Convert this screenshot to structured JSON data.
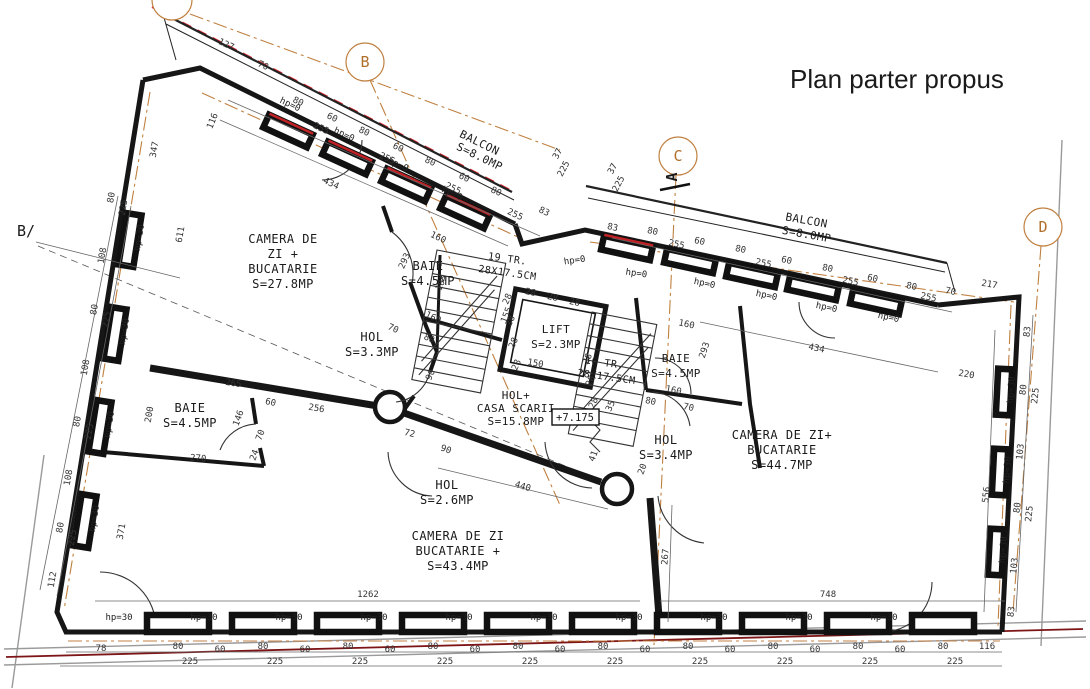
{
  "title": {
    "text": "Plan parter propus"
  },
  "colors": {
    "title": "#e0232a",
    "axis": "#c08040",
    "red_accent": "#d8232a"
  },
  "grid": {
    "b_left": "B/",
    "b": "B",
    "c": "C",
    "d": "D",
    "section_a": "A"
  },
  "labels": {
    "hp0": "hp=0",
    "hp30": "hp=30",
    "elevation": "+7.175",
    "tread": "28"
  },
  "rooms": {
    "camera1": {
      "line1": "CAMERA DE",
      "line2": "ZI +",
      "line3": "BUCATARIE",
      "area": "S=27.8MP"
    },
    "baie1": {
      "name": "BAIE",
      "area": "S=4.5MP"
    },
    "hol1": {
      "name": "HOL",
      "area": "S=3.3MP"
    },
    "lift": {
      "name": "LIFT",
      "area": "S=2.3MP"
    },
    "stairs_up": {
      "line1": "19 TR.",
      "line2": "28X17.5CM"
    },
    "stairs_down": {
      "line1": "16 TR.",
      "line2": "28X17.5CM"
    },
    "hol_scarii": {
      "line1": "HOL+",
      "line2": "CASA SCARII",
      "area": "S=15.8MP"
    },
    "baie2": {
      "name": "BAIE",
      "area": "S=4.5MP"
    },
    "hol2": {
      "name": "HOL",
      "area": "S=2.6MP"
    },
    "camera2": {
      "line1": "CAMERA DE ZI",
      "line2": "BUCATARIE +",
      "area": "S=43.4MP"
    },
    "hol3": {
      "name": "HOL",
      "area": "S=3.4MP"
    },
    "baie3": {
      "name": "BAIE",
      "area": "S=4.5MP"
    },
    "camera3": {
      "line1": "CAMERA DE ZI+",
      "line2": "BUCATARIE",
      "area": "S=44.7MP"
    },
    "balcon1": {
      "name": "BALCON",
      "area": "S=8.0MP"
    },
    "balcon2": {
      "name": "BALCON",
      "area": "S=8.0MP"
    }
  },
  "dims": {
    "bottom_chain": [
      "78",
      "80",
      "60",
      "80",
      "60",
      "80",
      "60",
      "80",
      "60",
      "80",
      "60",
      "80",
      "60",
      "80",
      "60",
      "80",
      "60",
      "80",
      "60",
      "80",
      "116"
    ],
    "bottom_axes": [
      "225",
      "225",
      "225",
      "225",
      "225",
      "225",
      "225",
      "225",
      "225",
      "225"
    ],
    "overall": [
      "1262",
      "748"
    ],
    "top_chain": [
      "127",
      "70",
      "80",
      "255",
      "60",
      "80",
      "255",
      "60",
      "80",
      "255",
      "60",
      "80",
      "255",
      "83"
    ],
    "notch": [
      "37",
      "225",
      "37",
      "225"
    ],
    "topright_chain": [
      "83",
      "80",
      "255",
      "60",
      "80",
      "255",
      "60",
      "80",
      "255",
      "60",
      "80",
      "255",
      "70"
    ],
    "right_chain": [
      "217",
      "83",
      "80",
      "225",
      "103",
      "80",
      "225",
      "103",
      "83"
    ],
    "left_chain": [
      "80",
      "225",
      "108",
      "80",
      "225",
      "108",
      "80",
      "225",
      "108",
      "80",
      "225",
      "112"
    ],
    "left_inner": [
      "347",
      "611",
      "200",
      "371"
    ],
    "interior": {
      "a434": "434",
      "a116": "116",
      "b160": "160",
      "b293": "293",
      "b160b": "160",
      "b80": "80",
      "b70": "70",
      "s105": "105",
      "s35": "35",
      "s90": "90",
      "s150": "150",
      "s155": "155",
      "c265": "265",
      "c270": "270",
      "c146": "146",
      "c70": "70",
      "c60": "60",
      "c256": "256",
      "c24": "24",
      "h72": "72",
      "h90": "90",
      "h41": "41",
      "h20": "20",
      "k440": "440",
      "k267": "267",
      "d160": "160",
      "d293": "293",
      "d160b": "160",
      "d80": "80",
      "d70": "70",
      "e434": "434",
      "e220": "220",
      "e556": "556"
    }
  }
}
